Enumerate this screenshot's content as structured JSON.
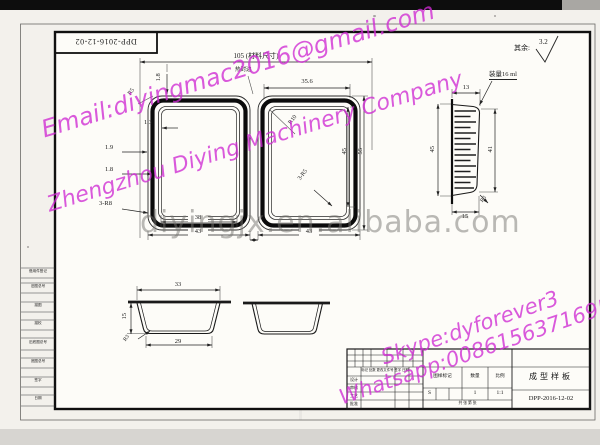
{
  "frame": {
    "doc_no_top": "DPP-2016-12-02"
  },
  "watermarks": {
    "email": "Email:diyingmac2016@gmail.com",
    "company": "Zhengzhou Diying Machinery Company",
    "website": "diyingjx.en.alibaba.com",
    "skype": "Skype:dyforever3",
    "whatsapp": "Whatsapp:008615637169572"
  },
  "general_note": {
    "prefix": "其余:",
    "roughness": "3.2"
  },
  "top_view": {
    "material_width": "105 (材料尺寸)",
    "seal_edge": "热封边",
    "pocket_mouth_width": "35.6",
    "rim_width_top": "1.8",
    "corner_top_left": "R5",
    "rim_step": "1.3",
    "rim_width_1": "1.9",
    "rim_width_2": "1.8",
    "corners_bottom_left": "3-R8",
    "corner_r10": "R10",
    "corners_right": "3-R5",
    "cavity_height": "45",
    "pocket_height": "55",
    "cavity_width": "38",
    "pocket_width_left": "43",
    "pocket_width_right": "43"
  },
  "side_view": {
    "volume": "装量16 ml",
    "top_width": "13",
    "height_left": "45",
    "height_right": "41",
    "bottom_width": "15",
    "corner": "R3"
  },
  "section_view": {
    "top_width": "33",
    "depth": "15",
    "bottom_width": "29",
    "corner": "R3"
  },
  "margin_labels": [
    "借用件登记",
    "旧图总号",
    "描图",
    "描校",
    "旧底图总号",
    "底图总号",
    "签字",
    "日期"
  ],
  "title_block": {
    "revision_header": "标记 处数 更改文件号 签字 日期",
    "roles": [
      "设计",
      "审核",
      "工艺",
      "批准"
    ],
    "col_mark": "图样标记",
    "col_qty": "数量",
    "col_scale": "比例",
    "val_mark": "S",
    "val_qty": "1",
    "val_scale": "1:1",
    "footer": "共 张  第 张",
    "title": "成型样板",
    "drawing_no": "DPP-2016-12-02"
  }
}
